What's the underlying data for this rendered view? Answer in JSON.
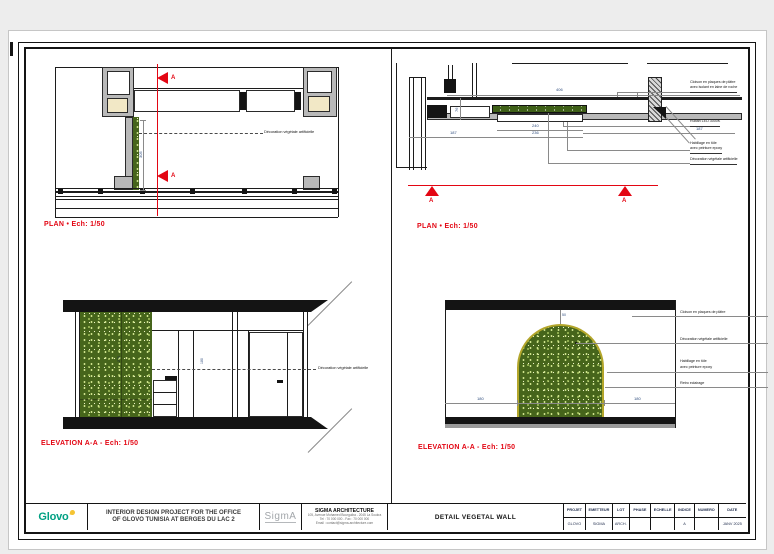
{
  "title_block": {
    "logo_text": "Glovo",
    "project_line1": "INTERIOR DESIGN PROJECT FOR THE OFFICE",
    "project_line2": "OF GLOVO TUNISIA AT BERGES DU LAC 2",
    "sigma_logo_text": "SigmA",
    "firm_name": "SIGMA ARCHITECTURE",
    "firm_line1": "105, Avenue Mohamed Bourguiba - 2045 La Soukra",
    "firm_line2": "Tel : 70 000 000 - Fax : 70 000 000",
    "firm_line3": "Email : contact@sigma-architecture.com",
    "drawing_title": "DETAIL VEGETAL WALL",
    "table_headers": [
      "PROJET",
      "EMETTEUR",
      "LOT",
      "PHASE",
      "ECHELLE",
      "INDICE",
      "NUMERO",
      "DATE"
    ],
    "table_values": [
      "GLOVO",
      "SIGMA",
      "ARCH.",
      "",
      "",
      "A",
      "",
      "JANV 2025"
    ]
  },
  "plan_left": {
    "caption": "PLAN  •  Ech: 1/50",
    "label_decoration": "Décoration végétale artificielle",
    "dim_height": "305",
    "marker": "A"
  },
  "plan_right": {
    "caption": "PLAN  •  Ech: 1/50",
    "label_cloison_1": "Cloison en plaques de plâtre",
    "label_cloison_2": "avec isolant en laine de roche",
    "label_led": "Ruban LED 3000K",
    "label_habillage_1": "Habillage en tôle",
    "label_habillage_2": "avec peinture epoxy",
    "label_decoration": "Décoration végétale artificielle",
    "dim_406": "406",
    "dim_240": "240",
    "dim_236": "236",
    "dim_187_left": "187",
    "dim_187_right": "187",
    "dim_76": "76",
    "marker": "A"
  },
  "elevation_left": {
    "caption": "ELEVATION A-A  -  Ech: 1/50",
    "label_decoration": "Décoration végétale artificielle",
    "dim_270": "270",
    "dim_180": "180"
  },
  "elevation_right": {
    "caption": "ELEVATION A-A  -  Ech: 1/50",
    "label_cloison": "Cloison en plaques de plâtre",
    "label_decoration": "Décoration végétale artificielle",
    "label_habillage_1": "Habillage en tôle",
    "label_habillage_2": "avec peinture epoxy",
    "label_retro": "Retro eclairage",
    "dim_180_left": "180",
    "dim_180_right": "180",
    "dim_50": "50"
  },
  "colors": {
    "accent_red": "#e30613",
    "vegetal_green": "#46651b",
    "glovo_green": "#00a082",
    "glovo_yellow": "#f5c433"
  }
}
